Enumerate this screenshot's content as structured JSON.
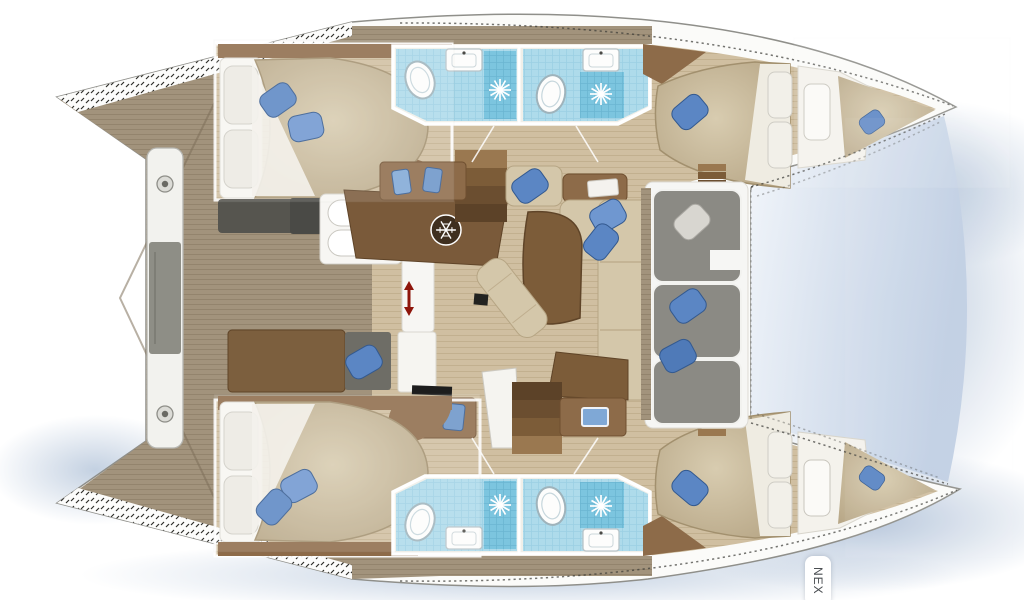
{
  "plan": {
    "type": "catamaran-yacht-floorplan",
    "view": "top-down deck and interior layout",
    "next_button": {
      "label": "NEX"
    },
    "hulls": 2,
    "cabins": [
      {
        "id": "port-aft-cabin",
        "double_bed": 1,
        "white_pillows": 2,
        "blue_pillows": 2
      },
      {
        "id": "port-forward-cabin",
        "double_bed": 1,
        "white_pillows": 2,
        "blue_pillows": 2,
        "extra_berth": 1
      },
      {
        "id": "starboard-aft-cabin",
        "double_bed": 1,
        "white_pillows": 2,
        "blue_pillows": 2
      },
      {
        "id": "starboard-forward-cabin",
        "double_bed": 1,
        "white_pillows": 2,
        "blue_pillows": 2,
        "extra_berth": 1
      }
    ],
    "bathrooms": [
      {
        "id": "port-head-1",
        "toilet": 1,
        "sink": 1,
        "shower": 1
      },
      {
        "id": "port-head-2",
        "toilet": 1,
        "sink": 1,
        "shower": 1
      },
      {
        "id": "starboard-head-1",
        "toilet": 1,
        "sink": 1,
        "shower": 1
      },
      {
        "id": "starboard-head-2",
        "toilet": 1,
        "sink": 1,
        "shower": 1
      }
    ],
    "salon": {
      "sofa_blue_pillows": 3,
      "dining_table": 1,
      "chaise_longue": 1,
      "galley_counter": 1,
      "stove": 1,
      "fridge": 1,
      "companionway_stairs": 2,
      "vanity_desks": 4
    },
    "forward_cockpit": {
      "gray_bench_sections": 3,
      "blue_pillows": 2,
      "white_pillows": 1
    },
    "aft_deck": {
      "crossbeam": 1,
      "bolt_fittings": 2,
      "seat_pad": 1
    },
    "icons": {
      "fridge": "snowflake-icon",
      "shower_drain": "starburst-icon",
      "companionway": "red-double-arrow-icon",
      "beam_fitting": "bolt-circle-icon"
    }
  },
  "palette": {
    "hull_white": "#fbfbf9",
    "deck": "#a2937c",
    "deck_line": "#93846d",
    "floor": "#d0bfa1",
    "floor_line": "#c2b08f",
    "wood": "#8d6b49",
    "wood_dark": "#6f4f30",
    "table": "#7c5c39",
    "beige": "#d4c7aa",
    "beige_dark": "#b6a584",
    "blue": "#5b86c4",
    "blue_dark": "#33598f",
    "tile": "#aedbeb",
    "tile_dark": "#7cc5df",
    "gray_sofa": "#8b8a84",
    "gray_dark": "#6f6e68",
    "white_soft": "#f6f5f1",
    "shadow": "#b3c2d8",
    "red": "#8e150b",
    "stair": "#9a7850",
    "stair_dark": "#7c5c38",
    "text": "#4a4e52"
  }
}
